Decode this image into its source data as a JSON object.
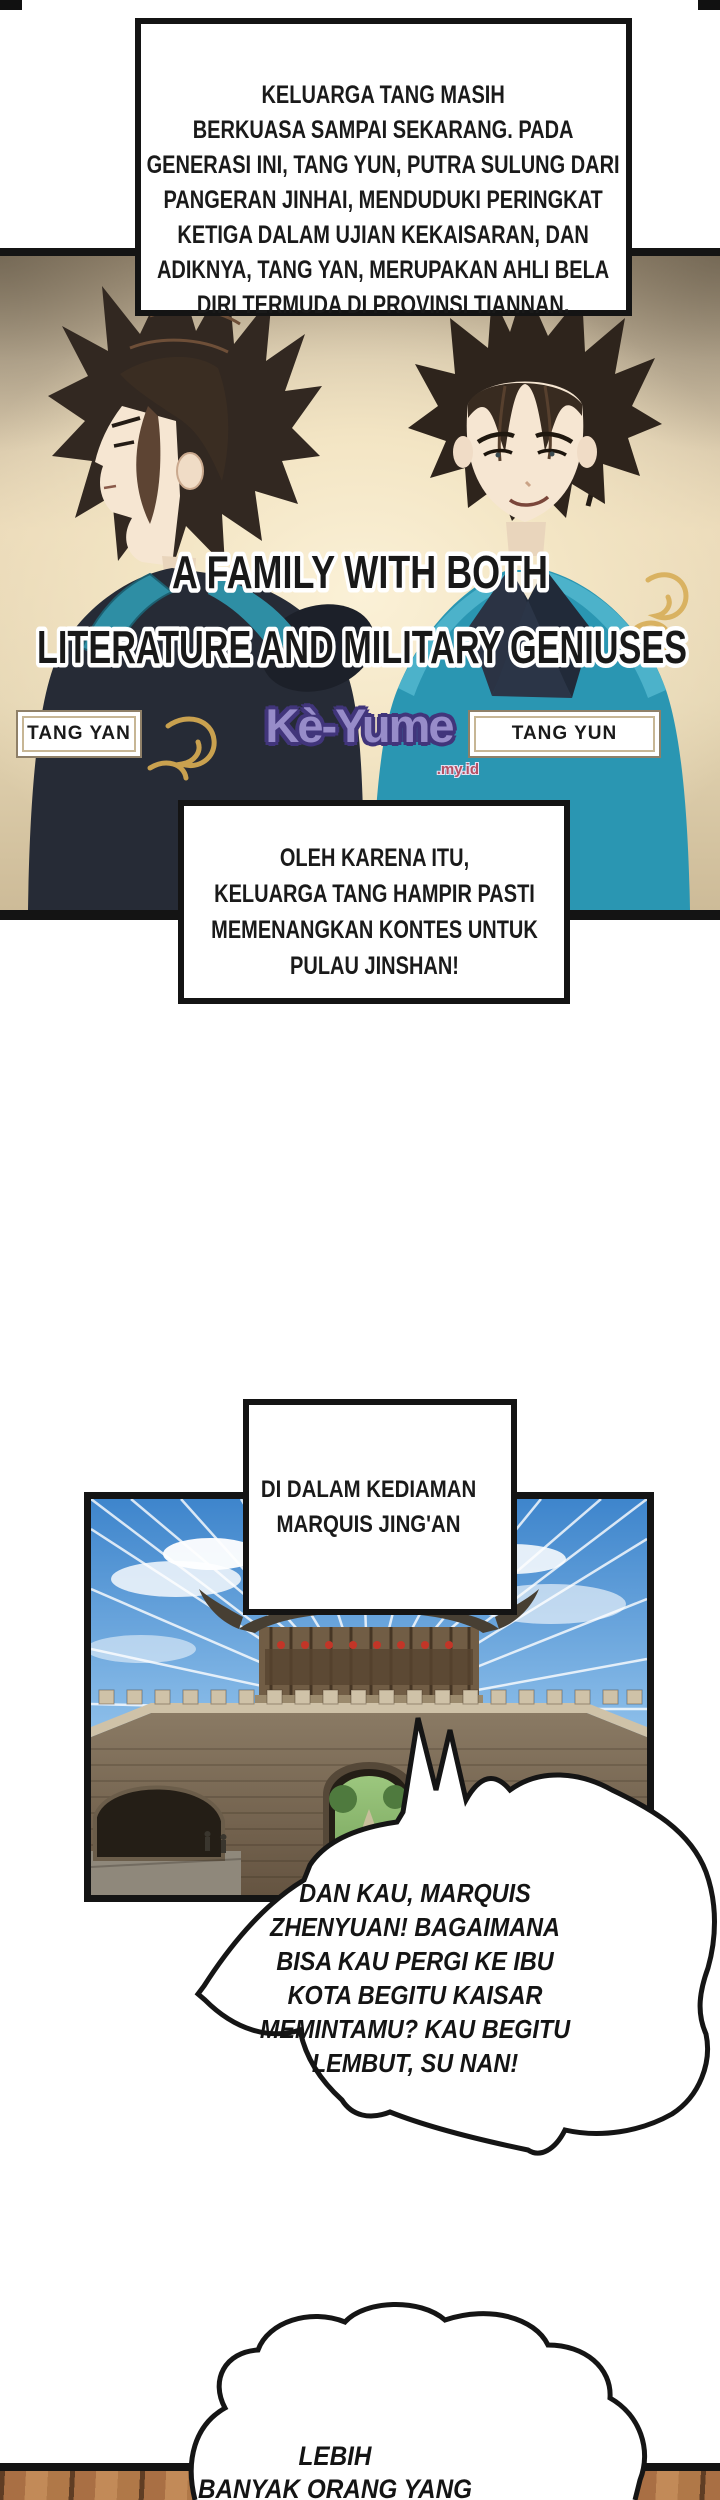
{
  "comic": {
    "narration_top": [
      "KELUARGA TANG MASIH",
      "BERKUASA SAMPAI SEKARANG. PADA",
      "GENERASI INI, TANG YUN, PUTRA SULUNG DARI",
      "PANGERAN JINHAI, MENDUDUKI PERINGKAT",
      "KETIGA DALAM UJIAN KEKAISARAN, DAN",
      "ADIKNYA, TANG YAN, MERUPAKAN AHLI BELA",
      "DIRI TERMUDA DI PROVINSI TIANNAN."
    ],
    "family_panel": {
      "title_line1": "A FAMILY WITH BOTH",
      "title_line2": "LITERATURE AND MILITARY GENIUSES",
      "label_left": "TANG YAN",
      "label_right": "TANG YUN",
      "watermark_text": "Kè-Yume",
      "watermark_suffix": ".my.id"
    },
    "narration_mid": [
      "OLEH KARENA ITU,",
      "KELUARGA TANG HAMPIR PASTI",
      "MEMENANGKAN KONTES UNTUK",
      "PULAU JINSHAN!"
    ],
    "caption_location": [
      "DI DALAM KEDIAMAN",
      "MARQUIS JING'AN"
    ],
    "bubble_main": [
      "DAN KAU, MARQUIS",
      "ZHENYUAN! BAGAIMANA",
      "BISA KAU PERGI KE IBU",
      "KOTA BEGITU KAISAR",
      "MEMINTAMU? KAU BEGITU",
      "LEMBUT, SU NAN!"
    ],
    "bubble_bottom": [
      "LEBIH",
      "BANYAK ORANG YANG"
    ],
    "colors": {
      "watermark_fill": "#978cc9",
      "watermark_outline": "#41357b",
      "watermark_suffix_color": "#b44f63",
      "panel_glow": "#f6ebcd",
      "robe_teal": "#2a96b2",
      "sky_blue": "#4a8fd4",
      "wood_brown": "#a96f44"
    }
  }
}
